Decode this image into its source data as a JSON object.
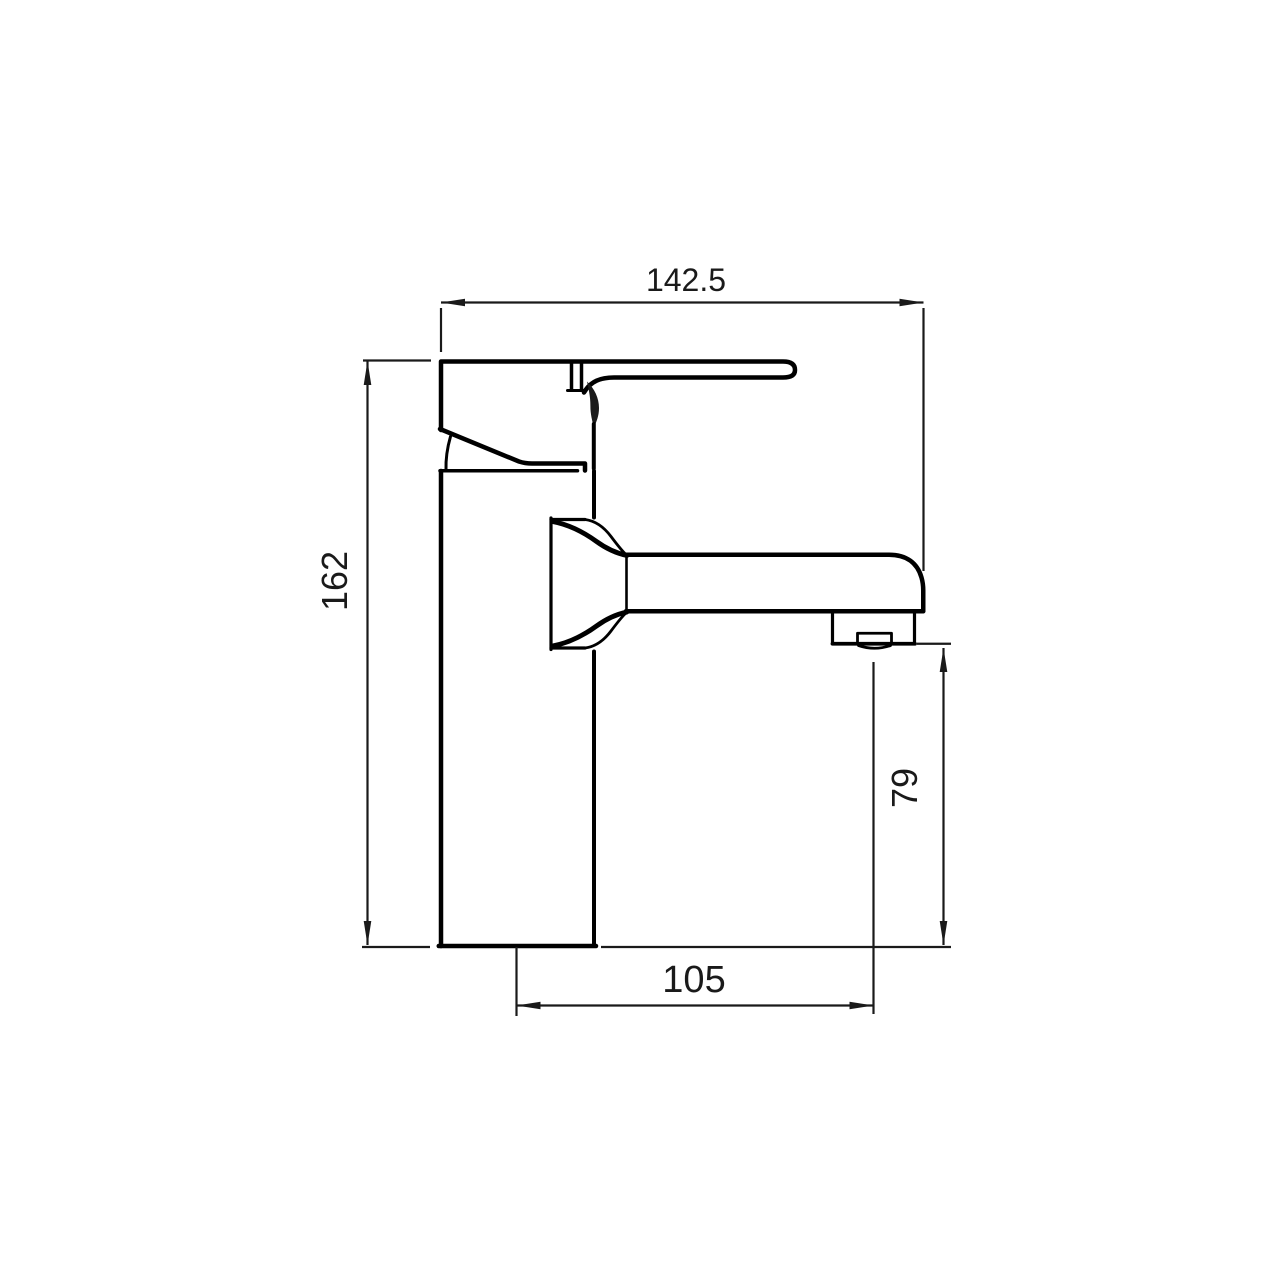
{
  "drawing": {
    "type": "technical-dimension-drawing",
    "subject": "basin mixer tap side elevation",
    "background_color": "#ffffff",
    "line_color": "#000000",
    "dimensions": {
      "top_width": {
        "label": "142.5"
      },
      "overall_height": {
        "label": "162"
      },
      "spout_height": {
        "label": "79"
      },
      "spout_reach": {
        "label": "105"
      }
    }
  }
}
